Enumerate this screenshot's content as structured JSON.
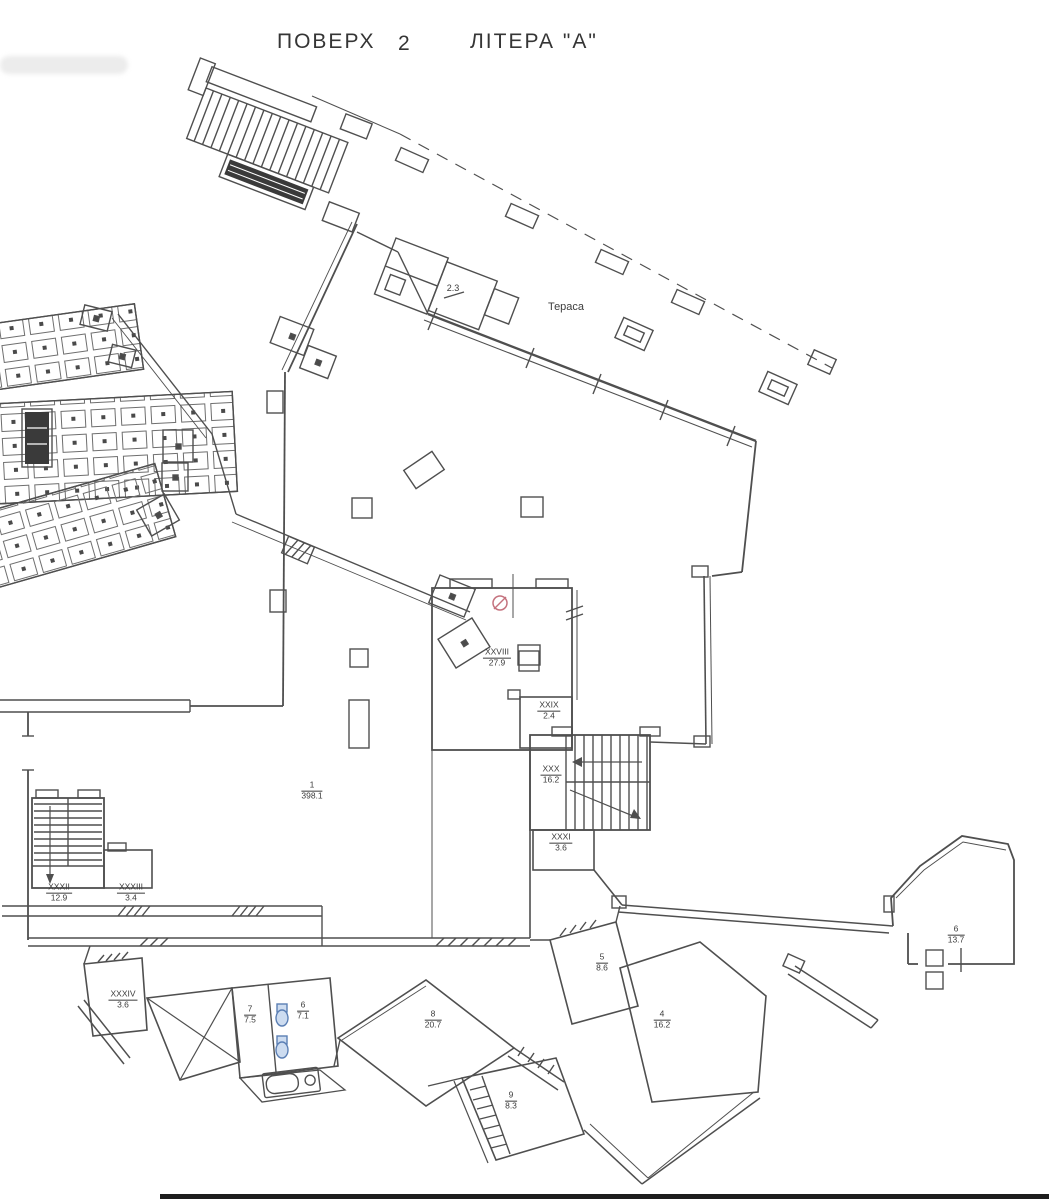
{
  "title": {
    "floor_word": "ПОВЕРХ",
    "floor_number": "2",
    "letter": "ЛІТЕРА \"А\""
  },
  "annotations": {
    "terrace": "Тераса",
    "terrace_area": "2.3"
  },
  "colors": {
    "line": "#4a4a4a",
    "dark_fill": "#3a3a3a",
    "fixture_blue": "#5b7fb4",
    "fixture_blue_fill": "#cddcf0",
    "marker_red": "#c4717d"
  },
  "rooms": {
    "hall": {
      "num": "1",
      "area": "398.1"
    },
    "xxviii": {
      "num": "XXVIII",
      "area": "27.9"
    },
    "xxix": {
      "num": "XXIX",
      "area": "2.4"
    },
    "xxx": {
      "num": "XXX",
      "area": "16.2"
    },
    "xxxi": {
      "num": "XXXI",
      "area": "3.6"
    },
    "xxxii": {
      "num": "XXXII",
      "area": "12.9"
    },
    "xxxiii": {
      "num": "XXXIII",
      "area": "3.4"
    },
    "xxxiv": {
      "num": "XXXIV",
      "area": "3.6"
    },
    "r7": {
      "num": "7",
      "area": "7.5"
    },
    "r6wc": {
      "num": "6",
      "area": "7.1"
    },
    "r8": {
      "num": "8",
      "area": "20.7"
    },
    "r5": {
      "num": "5",
      "area": "8.6"
    },
    "r4": {
      "num": "4",
      "area": "16.2"
    },
    "r9": {
      "num": "9",
      "area": "8.3"
    },
    "r6r": {
      "num": "6",
      "area": "13.7"
    }
  }
}
